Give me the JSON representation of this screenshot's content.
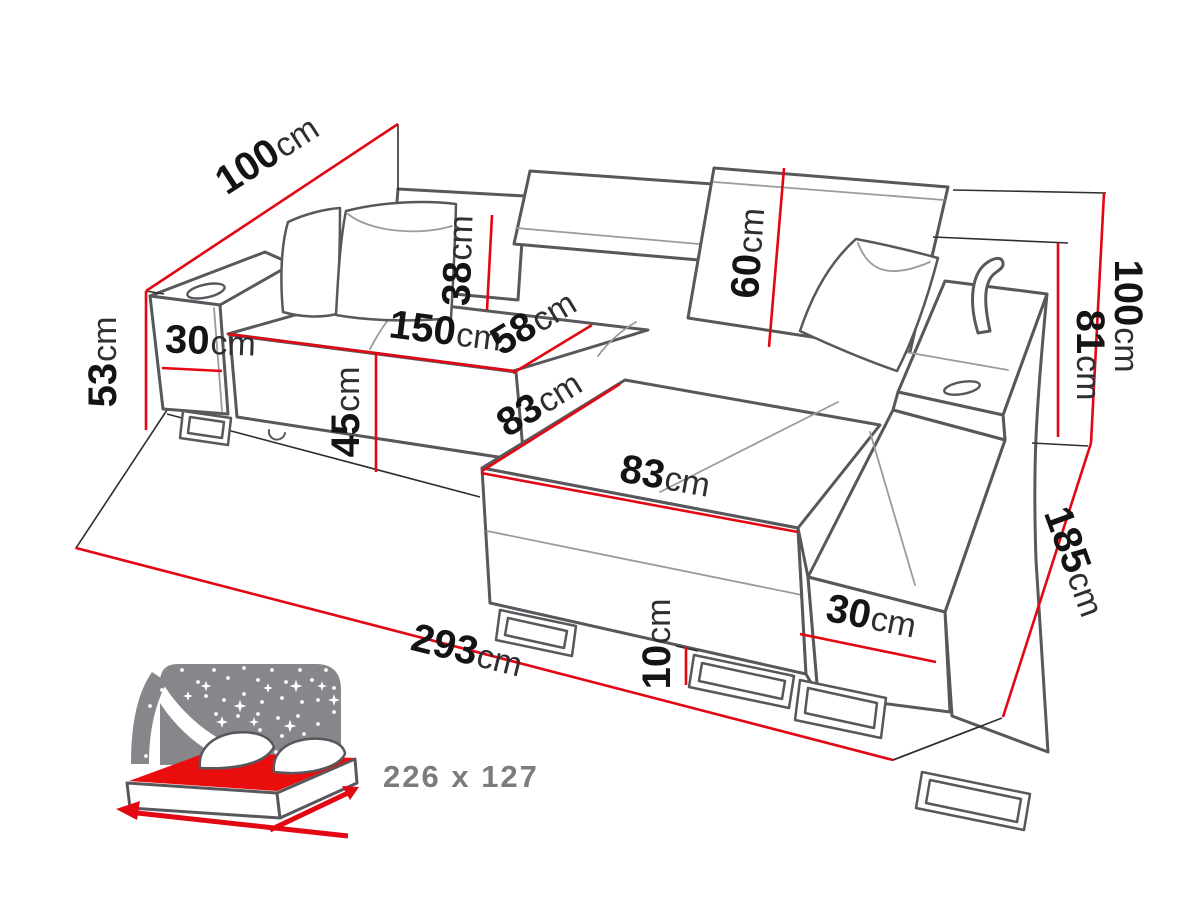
{
  "diagram": {
    "type": "corner-sofa dimension diagram",
    "dimensions": [
      {
        "id": "dim100_left",
        "value": "100",
        "unit": "cm"
      },
      {
        "id": "dim53",
        "value": "53",
        "unit": "cm"
      },
      {
        "id": "dim30_left",
        "value": "30",
        "unit": "cm"
      },
      {
        "id": "dim150",
        "value": "150",
        "unit": "cm"
      },
      {
        "id": "dim45",
        "value": "45",
        "unit": "cm"
      },
      {
        "id": "dim38",
        "value": "38",
        "unit": "cm"
      },
      {
        "id": "dim58",
        "value": "58",
        "unit": "cm"
      },
      {
        "id": "dim60",
        "value": "60",
        "unit": "cm"
      },
      {
        "id": "dim83_upper",
        "value": "83",
        "unit": "cm"
      },
      {
        "id": "dim83_lower",
        "value": "83",
        "unit": "cm"
      },
      {
        "id": "dim81",
        "value": "81",
        "unit": "cm"
      },
      {
        "id": "dim100_right",
        "value": "100",
        "unit": "cm"
      },
      {
        "id": "dim185",
        "value": "185",
        "unit": "cm"
      },
      {
        "id": "dim30_right",
        "value": "30",
        "unit": "cm"
      },
      {
        "id": "dim10",
        "value": "10",
        "unit": "cm"
      },
      {
        "id": "dim293",
        "value": "293",
        "unit": "cm"
      }
    ]
  },
  "bed_icon": {
    "size_label": "226 x 127"
  },
  "colors": {
    "dimension_red": "#e30613",
    "outline_gray": "#58585c",
    "outline_gray_light": "#9b9b9f",
    "ink_black": "#2e2e30",
    "label_black": "#141414",
    "unit_gray": "#2f2f33",
    "sky_gray": "#87878b",
    "bed_mattress_red": "#ea0d0d",
    "bed_size_gray": "#7b7b80"
  }
}
